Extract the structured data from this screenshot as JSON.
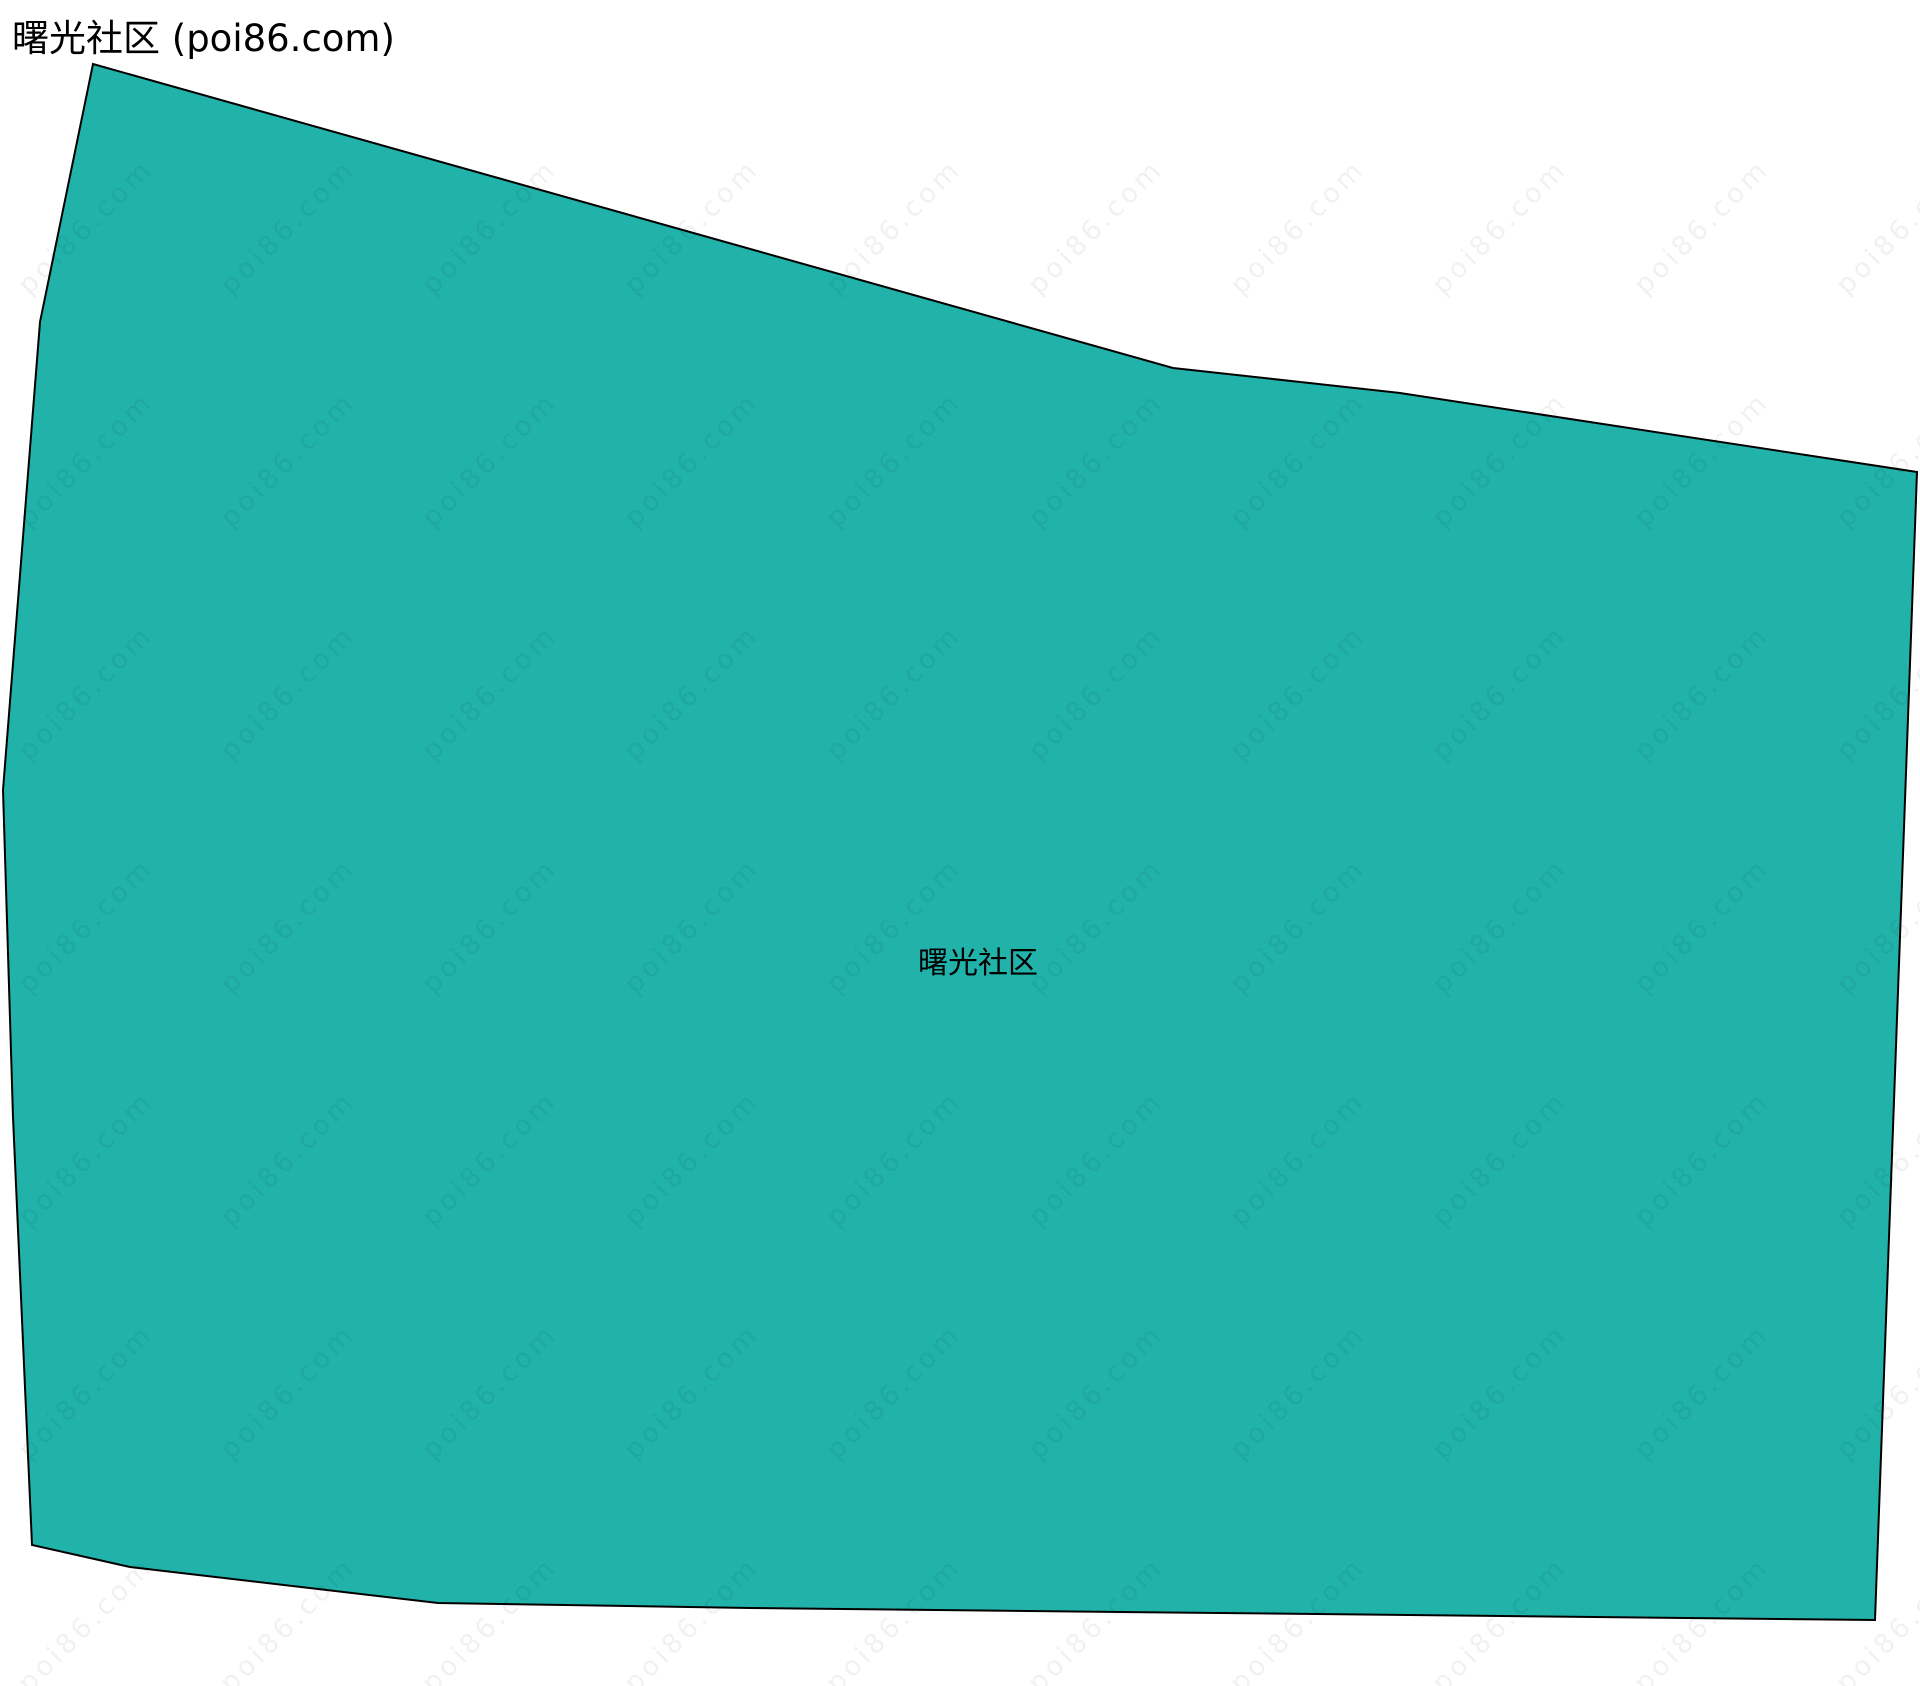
{
  "page": {
    "title": "曙光社区 (poi86.com)"
  },
  "map": {
    "region_label": "曙光社区",
    "label_x": 978,
    "label_y": 960,
    "fill_color": "#21B2AA",
    "stroke_color": "#000000",
    "stroke_width": 2,
    "polygon_points": "93,64 1173,368 1400,393 1917,472 1875,1620 750,1608 438,1603 130,1567 32,1545 13,1117 3,790 40,322"
  },
  "watermark": {
    "text": "poi86.com",
    "color": "rgba(0,0,0,0.055)",
    "grid": {
      "start_x": 86,
      "start_y": 227,
      "step_x": 202,
      "step_y": 233,
      "cols": 10,
      "rows": 7
    }
  }
}
